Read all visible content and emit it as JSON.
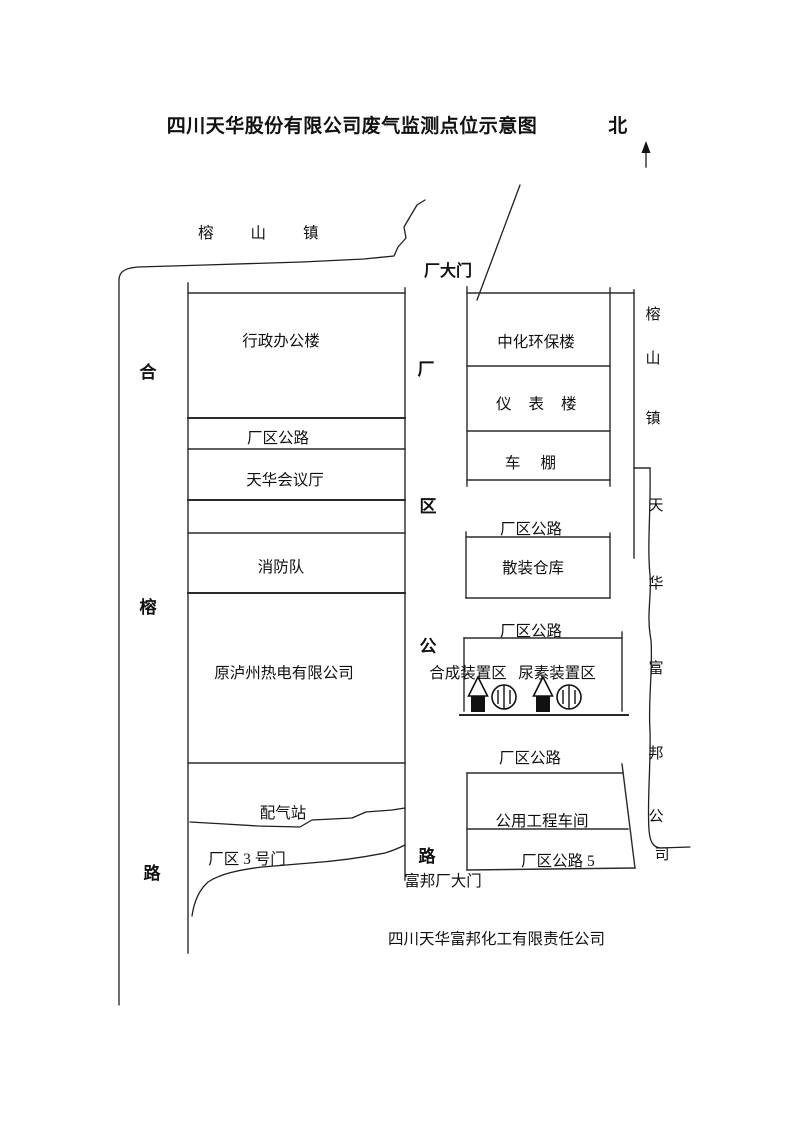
{
  "page": {
    "background": "#ffffff",
    "ink": "#111111"
  },
  "title": "四川天华股份有限公司废气监测点位示意图",
  "compass": {
    "label": "北",
    "direction": "up-arrow"
  },
  "roads_labels": {
    "town_top": "榕山镇",
    "left_road_chars": [
      "合",
      "榕",
      "路"
    ],
    "factory_road_chars": [
      "厂",
      "区",
      "公",
      "路"
    ],
    "town_right_chars": [
      "榕",
      "山",
      "镇"
    ],
    "fubang_company_chars": [
      "天",
      "华",
      "富",
      "邦",
      "公",
      "司"
    ]
  },
  "gates": {
    "main": "厂大门",
    "no3": "厂区 3 号门",
    "fubang": "富邦厂大门"
  },
  "west_zone": {
    "admin": "行政办公楼",
    "road": "厂区公路",
    "conference": "天华会议厅",
    "fire_brigade": "消防队",
    "power_company": "原泸州热电有限公司",
    "gas_station": "配气站"
  },
  "east_zone": {
    "env_building": "中化环保楼",
    "instrument_building": "仪表楼",
    "carport": "车棚",
    "road_1": "厂区公路",
    "bulk_warehouse": "散装仓库",
    "road_2": "厂区公路",
    "synthesis_area": "合成装置区",
    "urea_area": "尿素装置区",
    "road_3": "厂区公路",
    "utility_workshop": "公用工程车间",
    "road_5": "厂区公路 5"
  },
  "footer": {
    "company": "四川天华富邦化工有限责任公司"
  },
  "icons": {
    "stack": "chimney-stack-icon",
    "tank": "storage-tank-icon",
    "north_arrow": "north-arrow-icon"
  }
}
